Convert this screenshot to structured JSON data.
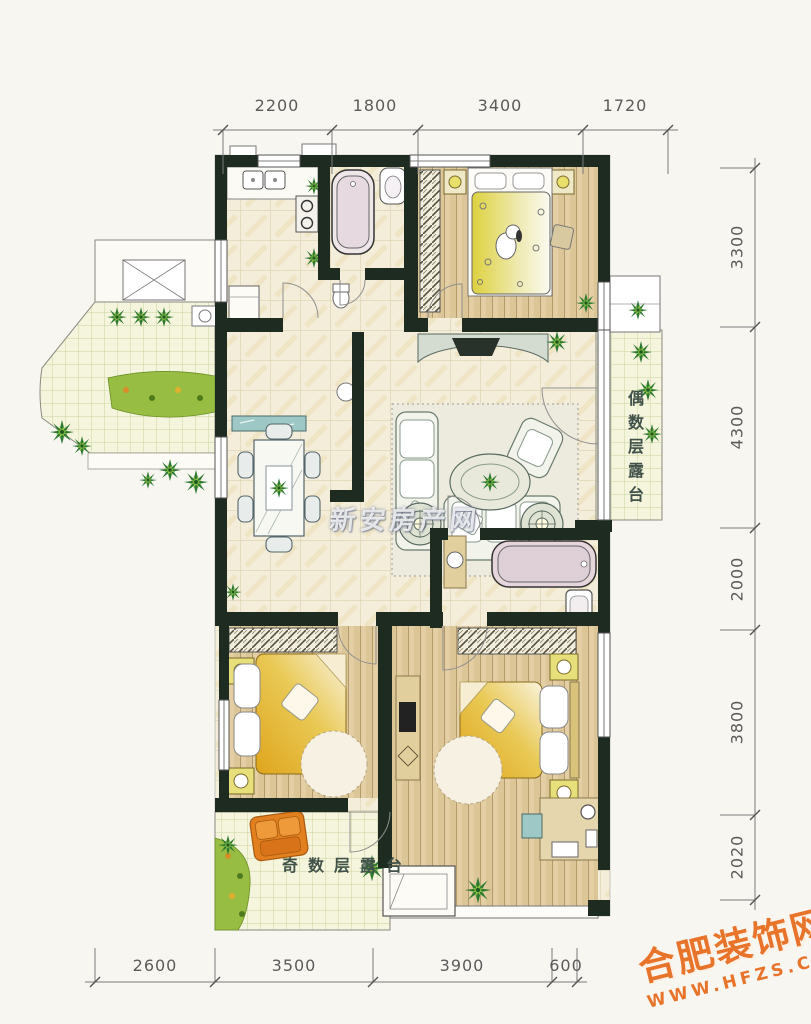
{
  "page": {
    "background": "#f7f6f1"
  },
  "plan": {
    "kind": "residential floor plan",
    "colors": {
      "wall": "#1d2b21",
      "tile_floor": "#f3edda",
      "wood_floor": "#dcc697",
      "terrace_floor": "#f5f4dc",
      "quilt_yellow": "#e2ae22",
      "plant_green": "#2f7a33",
      "teal_accent": "#9ec8c6",
      "orange_chair": "#e2801f",
      "dimension_text": "#5b5b5b",
      "watermark_orange": "#e8732a"
    }
  },
  "dimensions": {
    "top": [
      "2200",
      "1800",
      "3400",
      "1720"
    ],
    "bottom": [
      "2600",
      "3500",
      "3900",
      "600"
    ],
    "right": [
      "3300",
      "4300",
      "2000",
      "3800",
      "2020"
    ]
  },
  "labels": {
    "terrace_even": "偶数层露台",
    "terrace_odd": "奇数层露台"
  },
  "watermarks": {
    "center": "新安房产网",
    "brand_name": "合肥装饰网",
    "brand_url": "WWW.HFZS.CN"
  }
}
